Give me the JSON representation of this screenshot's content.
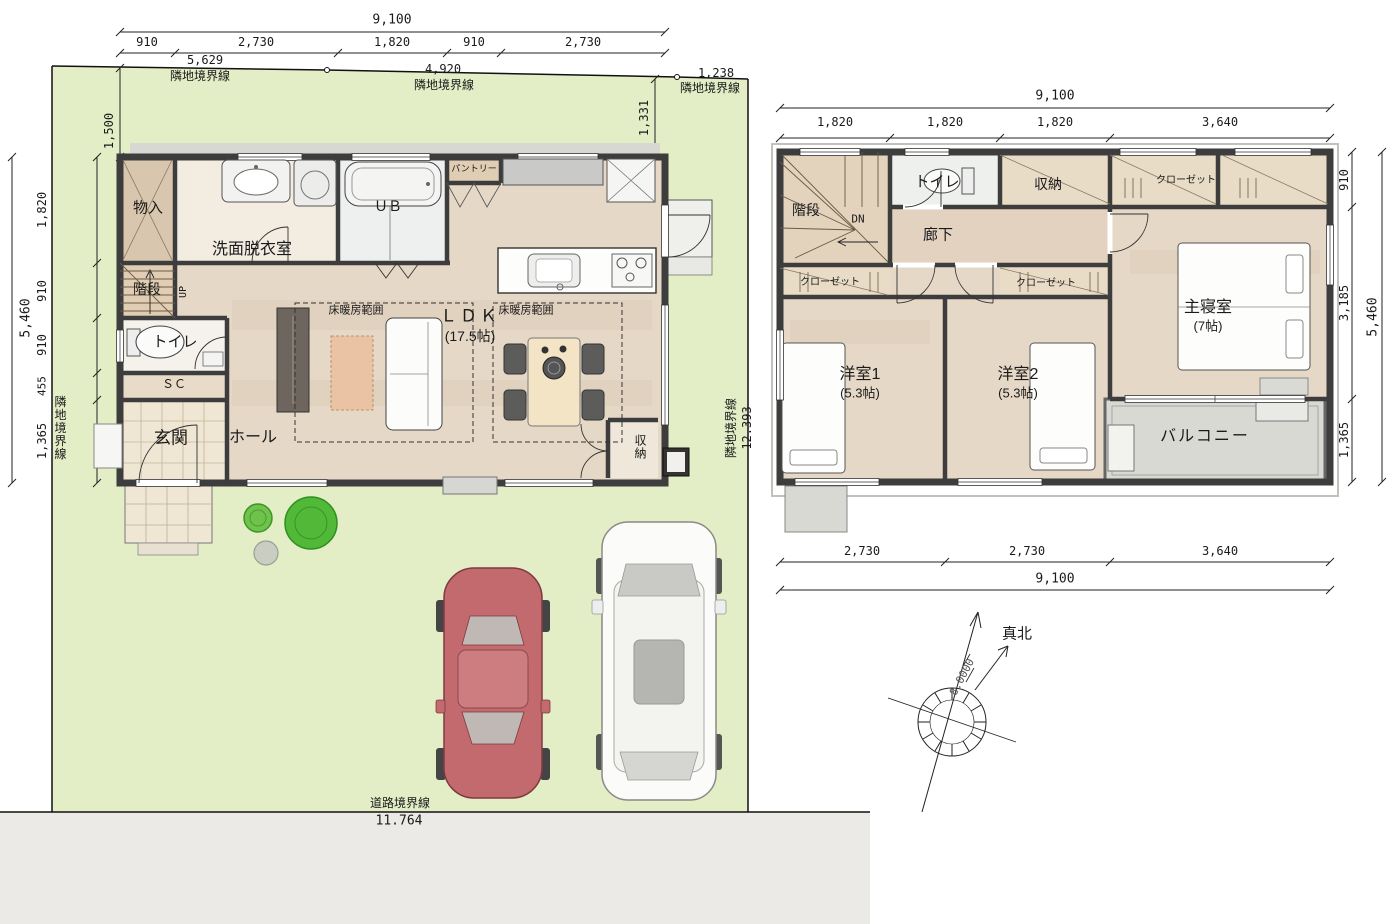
{
  "site": {
    "boundaries": {
      "top": [
        {
          "value": "5,629",
          "label": "隣地境界線"
        },
        {
          "value": "4,920",
          "label": "隣地境界線"
        },
        {
          "value": "1,238",
          "label": "隣地境界線"
        }
      ],
      "left": {
        "label": "隣地境界線"
      },
      "right": {
        "label": "隣地境界線",
        "value": "12.393"
      },
      "road": {
        "label": "道路境界線",
        "value": "11.764"
      }
    },
    "offset_left": "1,500",
    "offset_right": "1,331",
    "north": {
      "label": "真北",
      "angle": "8.0000"
    }
  },
  "floor1": {
    "dims": {
      "top_total": "9,100",
      "top_segments": [
        "910",
        "2,730",
        "1,820",
        "910",
        "2,730"
      ],
      "left_total": "5,460",
      "left_segments": [
        "1,820",
        "910",
        "910",
        "455",
        "1,365"
      ]
    },
    "rooms": {
      "monoire": "物入",
      "senmen": "洗面脱衣室",
      "ub": "ＵＢ",
      "pantry": "パントリー",
      "kaidan": "階段",
      "up": "UP",
      "toilet": "トイレ",
      "sc": "ＳＣ",
      "genkan": "玄関",
      "hall": "ホール",
      "ldk": "ＬＤＫ",
      "ldk_size": "(17.5帖)",
      "yukadanbou": "床暖房範囲",
      "shuunou": "収納"
    }
  },
  "floor2": {
    "dims": {
      "top_total": "9,100",
      "top_segments": [
        "1,820",
        "1,820",
        "1,820",
        "3,640"
      ],
      "bottom_segments": [
        "2,730",
        "2,730",
        "3,640"
      ],
      "bottom_total": "9,100",
      "right_total": "5,460",
      "right_segments": [
        "910",
        "3,185",
        "1,365"
      ]
    },
    "rooms": {
      "kaidan": "階段",
      "dn": "DN",
      "toilet": "トイレ",
      "shuunou": "収納",
      "rouka": "廊下",
      "closet": "クローゼット",
      "yoshitsu1": "洋室1",
      "yoshitsu1_size": "(5.3帖)",
      "yoshitsu2": "洋室2",
      "yoshitsu2_size": "(5.3帖)",
      "shinshitsu": "主寝室",
      "shinshitsu_size": "(7帖)",
      "balcony": "バルコニー"
    }
  },
  "colors": {
    "site_green": "#e3edc6",
    "road_gray": "#eceae7",
    "wall_dark": "#3d3d3d",
    "floor_wood": "#e6d8c7",
    "balcony_gray": "#d9d9d4",
    "car_red": "#c26a6e",
    "tree_green": "#52b838"
  }
}
